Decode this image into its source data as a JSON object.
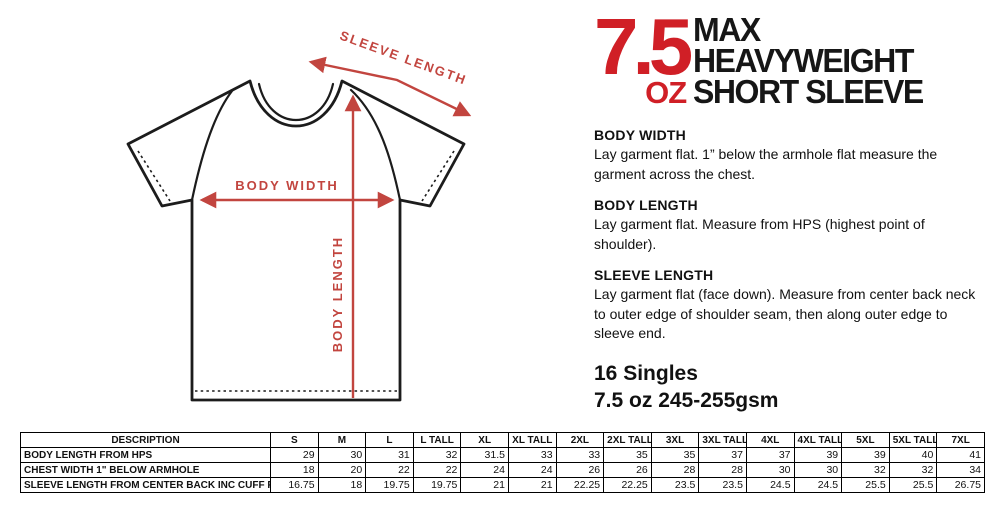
{
  "title": {
    "oz_number": "7.5",
    "oz_unit": "OZ",
    "line1": "MAX",
    "line2": "HEAVYWEIGHT",
    "line3": "SHORT SLEEVE"
  },
  "colors": {
    "title_red": "#d01f26",
    "annotation_red": "#c2453f",
    "outline_black": "#1c1c1c"
  },
  "diagram": {
    "sleeve_length_label": "SLEEVE LENGTH",
    "body_width_label": "BODY WIDTH",
    "body_length_label": "BODY LENGTH"
  },
  "sections": [
    {
      "heading": "BODY WIDTH",
      "body": "Lay garment flat. 1” below the armhole flat measure the garment across the chest."
    },
    {
      "heading": "BODY LENGTH",
      "body": "Lay garment flat. Measure from HPS (highest point of shoulder)."
    },
    {
      "heading": "SLEEVE LENGTH",
      "body": "Lay garment flat (face down). Measure from center back neck to outer edge of shoulder seam, then along outer edge to sleeve end."
    }
  ],
  "fabric": {
    "line1": "16 Singles",
    "line2": "7.5 oz 245-255gsm"
  },
  "table": {
    "description_header": "DESCRIPTION",
    "size_columns": [
      "S",
      "M",
      "L",
      "L TALL",
      "XL",
      "XL TALL",
      "2XL",
      "2XL TALL",
      "3XL",
      "3XL TALL",
      "4XL",
      "4XL TALL",
      "5XL",
      "5XL TALL",
      "7XL"
    ],
    "rows": [
      {
        "label": "BODY LENGTH FROM HPS",
        "values": [
          "29",
          "30",
          "31",
          "32",
          "31.5",
          "33",
          "33",
          "35",
          "35",
          "37",
          "37",
          "39",
          "39",
          "40",
          "41"
        ]
      },
      {
        "label": "CHEST WIDTH 1\" BELOW ARMHOLE",
        "values": [
          "18",
          "20",
          "22",
          "22",
          "24",
          "24",
          "26",
          "26",
          "28",
          "28",
          "30",
          "30",
          "32",
          "32",
          "34"
        ]
      },
      {
        "label": "SLEEVE LENGTH FROM CENTER BACK INC CUFF RIB",
        "values": [
          "16.75",
          "18",
          "19.75",
          "19.75",
          "21",
          "21",
          "22.25",
          "22.25",
          "23.5",
          "23.5",
          "24.5",
          "24.5",
          "25.5",
          "25.5",
          "26.75"
        ]
      }
    ]
  }
}
